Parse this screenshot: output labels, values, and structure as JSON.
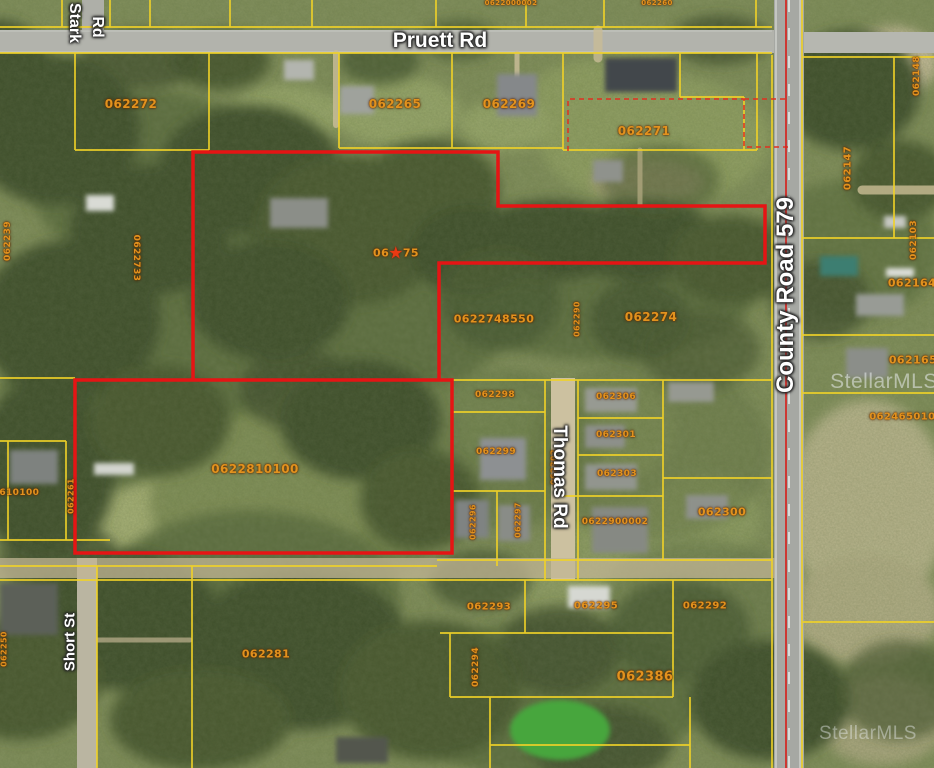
{
  "map": {
    "type": "aerial-parcel-map",
    "watermark": "StellarMLS",
    "colors": {
      "parcel_line": "#f0d228",
      "subject_outline": "#e61414",
      "dashed_boundary": "#e03020",
      "parcel_label": "#e2921e",
      "road_label": "#ffffff"
    },
    "subject": {
      "parcel_id": "0622810100",
      "marked_parcel": "062275",
      "outline_color": "#e61414"
    },
    "road_labels": [
      {
        "id": "pruett-rd",
        "label": "Pruett Rd",
        "x": 440,
        "y": 41,
        "rot": 0,
        "size": 21
      },
      {
        "id": "stark-rd-line1",
        "label": "Stark",
        "x": 74,
        "y": 23,
        "rot": 90,
        "size": 16
      },
      {
        "id": "stark-rd-line2",
        "label": "Rd",
        "x": 97,
        "y": 27,
        "rot": 90,
        "size": 16
      },
      {
        "id": "county-road-579",
        "label": "County Road 579",
        "x": 786,
        "y": 295,
        "rot": -90,
        "size": 24
      },
      {
        "id": "thomas-rd",
        "label": "Thomas Rd",
        "x": 559,
        "y": 477,
        "rot": 90,
        "size": 19
      },
      {
        "id": "short-st",
        "label": "Short St",
        "x": 70,
        "y": 642,
        "rot": -90,
        "size": 15
      }
    ],
    "parcel_labels": [
      {
        "id": "062272",
        "x": 131,
        "y": 104,
        "size": 12
      },
      {
        "id": "062239",
        "x": 8,
        "y": 241,
        "size": 9,
        "vertical": true
      },
      {
        "id": "0622733",
        "x": 136,
        "y": 258,
        "size": 9,
        "vertical": true,
        "rot": 90
      },
      {
        "id": "062265",
        "x": 395,
        "y": 104,
        "size": 12
      },
      {
        "id": "062269",
        "x": 509,
        "y": 104,
        "size": 12
      },
      {
        "id": "062271",
        "x": 644,
        "y": 131,
        "size": 12
      },
      {
        "id": "062275",
        "x": 396,
        "y": 253,
        "size": 11,
        "starred": true,
        "display_prefix": "06",
        "display_suffix": "75"
      },
      {
        "id": "0622748550",
        "x": 494,
        "y": 319,
        "size": 11
      },
      {
        "id": "062290",
        "x": 577,
        "y": 319,
        "size": 8,
        "vertical": true
      },
      {
        "id": "062274",
        "x": 651,
        "y": 317,
        "size": 12
      },
      {
        "id": "062147",
        "x": 848,
        "y": 168,
        "size": 10,
        "vertical": true
      },
      {
        "id": "062148",
        "x": 917,
        "y": 76,
        "size": 9,
        "vertical": true
      },
      {
        "id": "062103",
        "x": 914,
        "y": 240,
        "size": 9,
        "vertical": true
      },
      {
        "id": "062164",
        "x": 912,
        "y": 283,
        "size": 11
      },
      {
        "id": "062165",
        "x": 913,
        "y": 360,
        "size": 11
      },
      {
        "id": "0624650100",
        "x": 906,
        "y": 417,
        "size": 10
      },
      {
        "id": "062298",
        "x": 495,
        "y": 395,
        "size": 9
      },
      {
        "id": "062306",
        "x": 616,
        "y": 397,
        "size": 9
      },
      {
        "id": "062301",
        "x": 616,
        "y": 435,
        "size": 9
      },
      {
        "id": "062303",
        "x": 617,
        "y": 474,
        "size": 9
      },
      {
        "id": "0622900002",
        "x": 615,
        "y": 522,
        "size": 9
      },
      {
        "id": "062299",
        "x": 496,
        "y": 452,
        "size": 9
      },
      {
        "id": "062302",
        "x": 554,
        "y": 467,
        "size": 8,
        "vertical": true
      },
      {
        "id": "062296",
        "x": 473,
        "y": 522,
        "size": 8,
        "vertical": true
      },
      {
        "id": "062297",
        "x": 518,
        "y": 520,
        "size": 8,
        "vertical": true
      },
      {
        "id": "062300",
        "x": 722,
        "y": 512,
        "size": 11
      },
      {
        "id": "0622810100",
        "x": 255,
        "y": 469,
        "size": 12
      },
      {
        "id": "062293",
        "x": 489,
        "y": 607,
        "size": 10
      },
      {
        "id": "062295",
        "x": 596,
        "y": 606,
        "size": 10
      },
      {
        "id": "062292",
        "x": 705,
        "y": 606,
        "size": 10
      },
      {
        "id": "062294",
        "x": 476,
        "y": 667,
        "size": 9,
        "vertical": true
      },
      {
        "id": "062386",
        "x": 645,
        "y": 677,
        "size": 13
      },
      {
        "id": "062281",
        "x": 266,
        "y": 654,
        "size": 11
      },
      {
        "id": "0622610100",
        "x": 6,
        "y": 493,
        "size": 9
      },
      {
        "id": "062261",
        "x": 71,
        "y": 496,
        "size": 8,
        "vertical": true
      },
      {
        "id": "062250",
        "x": 4,
        "y": 649,
        "size": 8,
        "vertical": true
      },
      {
        "id": "0622000002",
        "x": 511,
        "y": 3,
        "size": 7
      },
      {
        "id": "062260",
        "x": 657,
        "y": 3,
        "size": 7
      }
    ],
    "watermarks": [
      {
        "x": 884,
        "y": 382
      },
      {
        "x": 868,
        "y": 734
      }
    ]
  }
}
